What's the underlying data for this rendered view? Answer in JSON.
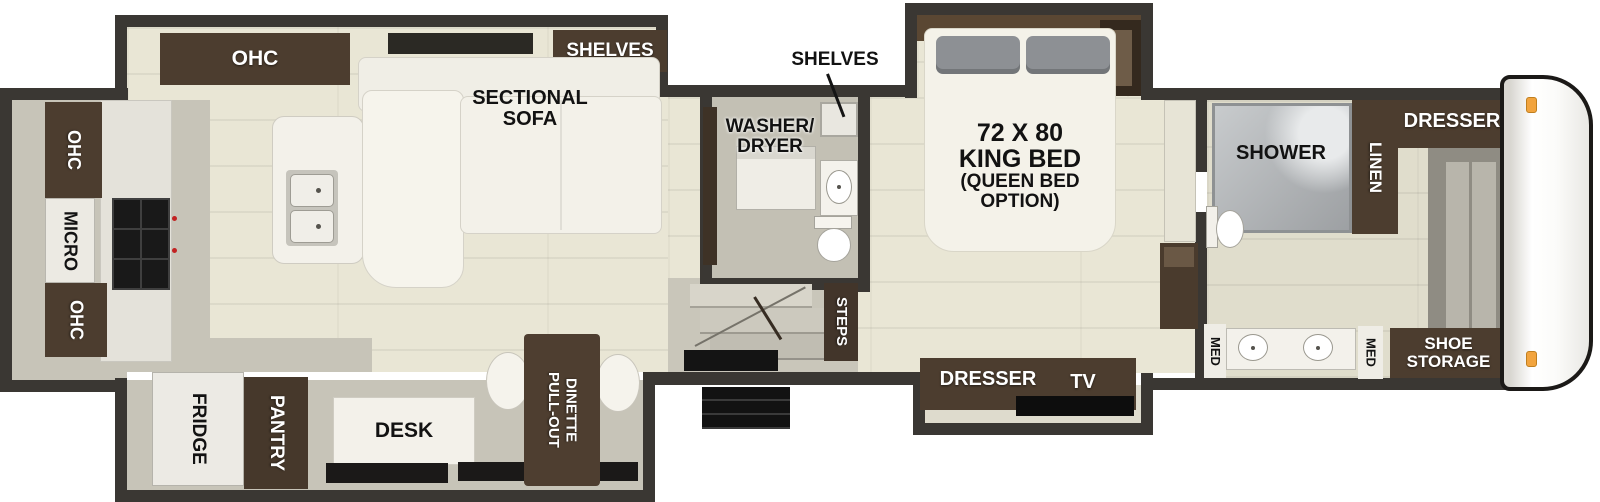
{
  "colors": {
    "wall": "#3a3733",
    "floor": "#e9e6d5",
    "floor_gray": "#c7c4b8",
    "brown": "#4c3d2f",
    "brown_dark": "#46382b",
    "white_furn": "#f3f1ea",
    "bed": "#f4f2e9",
    "pillow": "#8d9094",
    "shower_gray": "#b4b7ba",
    "black_item": "#151513",
    "accent_orange": "#f2a43e",
    "text_dark": "#121212",
    "text_light": "#ffffff"
  },
  "labels": {
    "ohc_top": "OHC",
    "shelves_living": "SHELVES",
    "sectional_sofa": "SECTIONAL\nSOFA",
    "shelves_mid": "SHELVES",
    "washer_dryer": "WASHER/\nDRYER",
    "bed_title": "72 X 80\nKING BED",
    "bed_option": "(QUEEN BED\nOPTION)",
    "shower": "SHOWER",
    "linen": "LINEN",
    "dresser_front": "DRESSER",
    "ohc_rear_top": "OHC",
    "micro": "MICRO",
    "ohc_rear_bottom": "OHC",
    "fridge": "FRIDGE",
    "pantry": "PANTRY",
    "desk": "DESK",
    "dinette": "PULL-OUT\nDINETTE",
    "steps": "STEPS",
    "dresser_bedroom": "DRESSER",
    "tv": "TV",
    "med_left": "MED",
    "med_right": "MED",
    "shoe_storage": "SHOE\nSTORAGE"
  }
}
